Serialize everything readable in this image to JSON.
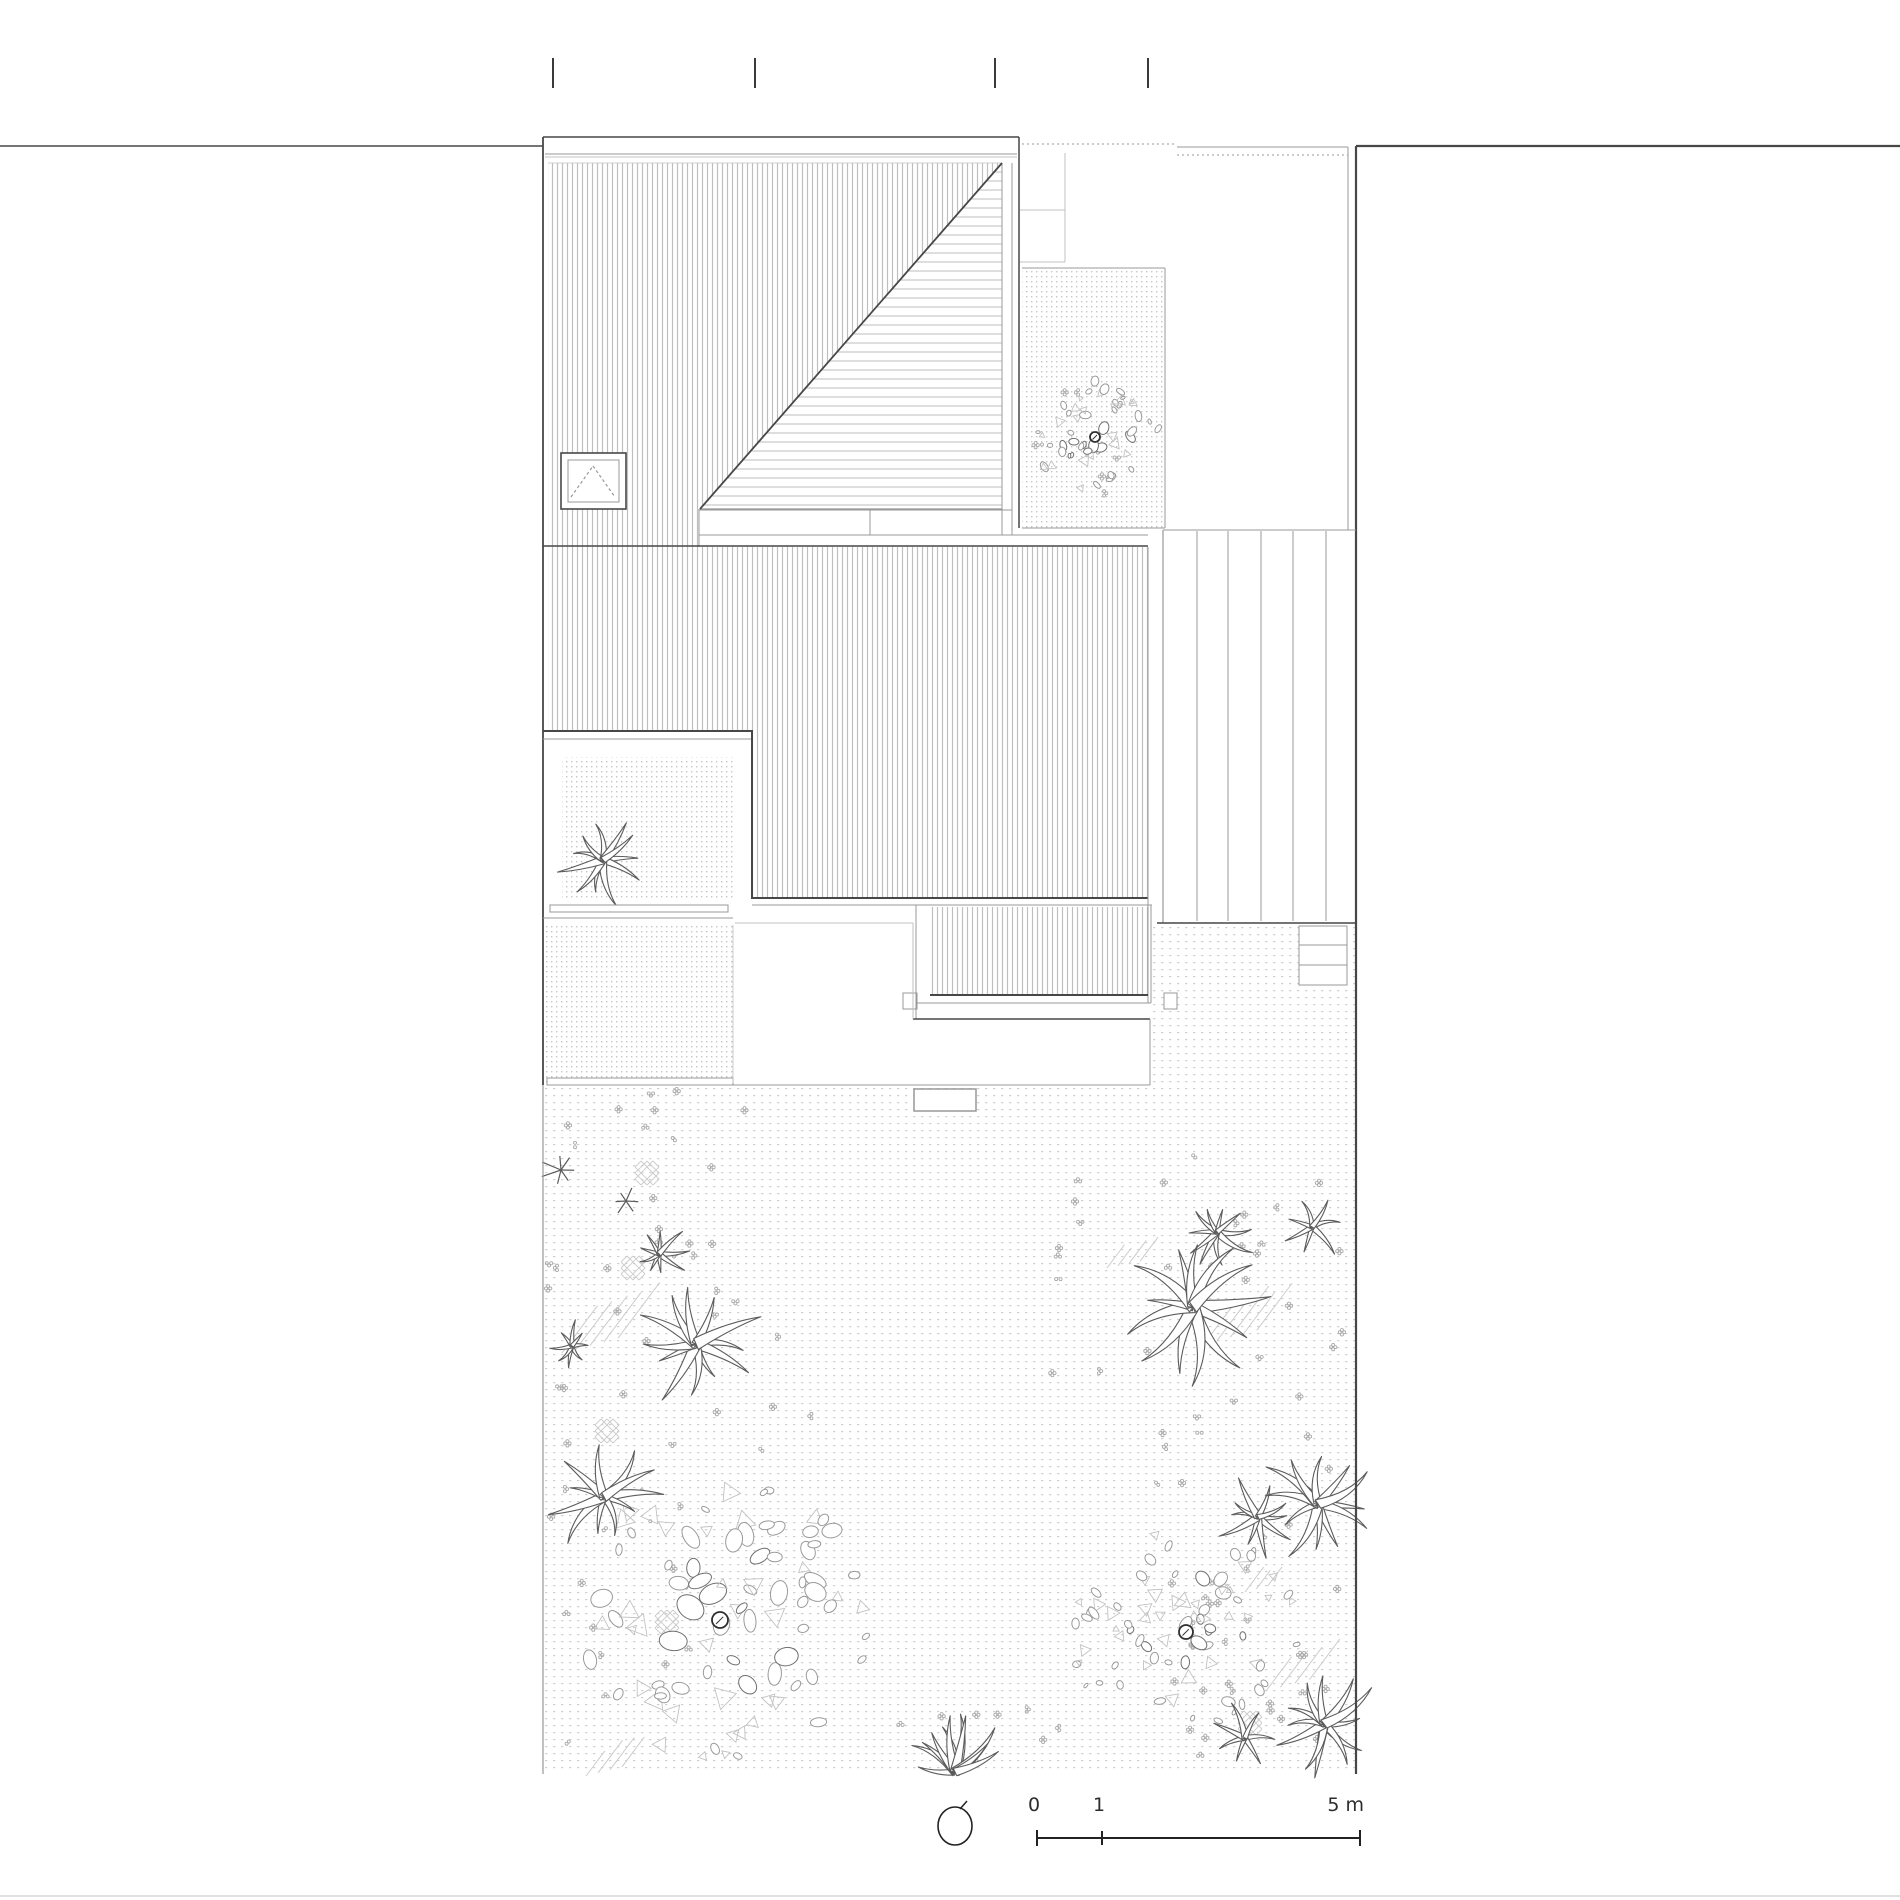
{
  "title": "roof-and-garden-site-plan",
  "legend": {
    "scale": {
      "zero": "0",
      "one": "1",
      "five": "5 m"
    }
  },
  "colors": {
    "dark": "#474747",
    "mid": "#989898",
    "light": "#c0c0c0",
    "hatch": "#bfbfbf",
    "tri_hatch": "#bdbdbd",
    "gravel_dot": "#c6c6c6",
    "garden_dot": "#d0d0d0",
    "stone_dark": "#6f6f6f",
    "stone_mid": "#9a9a9a",
    "stone_light": "#c2c2c2",
    "plant": "#5c5c5c",
    "blossom": "#ababab",
    "patch": "#cccccc"
  },
  "seed": 11,
  "plan": {
    "section_ticks": {
      "xs": [
        553,
        755,
        995,
        1148
      ],
      "y1": 58,
      "y2": 88
    },
    "vhatch_rects": [
      [
        548,
        163,
        454,
        346
      ],
      [
        548,
        509,
        151,
        38
      ],
      [
        548,
        547,
        600,
        184
      ],
      [
        752,
        731,
        396,
        167
      ],
      [
        930,
        907,
        218,
        88
      ]
    ],
    "triangle": {
      "apex_x": 1002,
      "apex_y": 163,
      "base_x": 700,
      "base_y": 509,
      "pitch": 9
    },
    "gravel_rects": [
      [
        545,
        925,
        188,
        158
      ],
      [
        562,
        757,
        173,
        141
      ],
      [
        1022,
        268,
        143,
        260
      ]
    ],
    "garden_rects": [
      [
        545,
        1087,
        605,
        685
      ],
      [
        1150,
        925,
        206,
        847
      ]
    ],
    "white_rects": [
      [
        699,
        510,
        313,
        25,
        "mid",
        1
      ],
      [
        914,
        1089,
        62,
        22,
        "mid",
        1.5
      ],
      [
        1299,
        926,
        48,
        59,
        "mid",
        1
      ],
      [
        550,
        905,
        178,
        7,
        "mid",
        1
      ],
      [
        547,
        1078,
        186,
        7,
        "mid",
        1
      ],
      [
        903,
        993,
        14,
        16,
        "mid",
        1
      ],
      [
        1164,
        993,
        13,
        16,
        "mid",
        1
      ],
      [
        561,
        453,
        65,
        56,
        "dark",
        1.6
      ],
      [
        568,
        460,
        51,
        42,
        "mid",
        1
      ]
    ],
    "lines": [
      [
        0,
        146,
        543,
        146,
        1.4,
        "dark",
        ""
      ],
      [
        1356,
        146,
        1900,
        146,
        2.2,
        "dark",
        ""
      ],
      [
        1356,
        146,
        1356,
        1774,
        2.2,
        "dark",
        ""
      ],
      [
        543,
        137,
        543,
        1085,
        1.8,
        "dark",
        ""
      ],
      [
        543,
        1085,
        543,
        1774,
        1.2,
        "mid",
        ""
      ],
      [
        543,
        137,
        1019,
        137,
        1.6,
        "dark",
        ""
      ],
      [
        545,
        154,
        1017,
        154,
        1,
        "mid",
        ""
      ],
      [
        545,
        157,
        1017,
        157,
        1,
        "light",
        ""
      ],
      [
        1019,
        137,
        1019,
        528,
        1.5,
        "dark",
        ""
      ],
      [
        1002,
        163,
        1002,
        535,
        1,
        "mid",
        ""
      ],
      [
        1012,
        163,
        1012,
        535,
        1,
        "mid",
        ""
      ],
      [
        548,
        163,
        1002,
        163,
        0.8,
        "light",
        ""
      ],
      [
        699,
        509,
        699,
        547,
        1,
        "mid",
        ""
      ],
      [
        700,
        509,
        1002,
        509,
        1.2,
        "mid",
        ""
      ],
      [
        870,
        510,
        870,
        535,
        1,
        "mid",
        ""
      ],
      [
        699,
        535,
        1148,
        535,
        1,
        "mid",
        ""
      ],
      [
        543,
        546,
        1148,
        546,
        1.6,
        "dark",
        ""
      ],
      [
        543,
        731,
        753,
        731,
        2,
        "dark",
        ""
      ],
      [
        543,
        739,
        753,
        739,
        1,
        "mid",
        ""
      ],
      [
        752,
        731,
        752,
        899,
        2,
        "dark",
        ""
      ],
      [
        752,
        898,
        1148,
        898,
        2,
        "dark",
        ""
      ],
      [
        752,
        905,
        1152,
        905,
        1,
        "mid",
        ""
      ],
      [
        1148,
        547,
        1148,
        1003,
        1,
        "mid",
        ""
      ],
      [
        1151,
        905,
        1151,
        1003,
        1,
        "mid",
        ""
      ],
      [
        930,
        995,
        1148,
        995,
        2,
        "dark",
        ""
      ],
      [
        916,
        1003,
        1151,
        1003,
        1,
        "mid",
        ""
      ],
      [
        916,
        905,
        916,
        1019,
        1,
        "mid",
        ""
      ],
      [
        913,
        1019,
        1150,
        1019,
        1.5,
        "dark",
        ""
      ],
      [
        1150,
        1019,
        1150,
        1085,
        1,
        "mid",
        ""
      ],
      [
        735,
        923,
        913,
        923,
        1,
        "light",
        ""
      ],
      [
        913,
        923,
        913,
        1019,
        1,
        "light",
        ""
      ],
      [
        543,
        918,
        733,
        918,
        1,
        "mid",
        ""
      ],
      [
        733,
        1085,
        1150,
        1085,
        1,
        "mid",
        ""
      ],
      [
        733,
        925,
        733,
        1083,
        0.8,
        "light",
        ""
      ],
      [
        1022,
        144,
        1177,
        144,
        1,
        "mid",
        "2,3"
      ],
      [
        1177,
        147,
        1348,
        147,
        1,
        "mid",
        ""
      ],
      [
        1177,
        155,
        1348,
        155,
        1,
        "mid",
        "2,3"
      ],
      [
        1065,
        153,
        1065,
        262,
        1,
        "light",
        ""
      ],
      [
        1020,
        210,
        1065,
        210,
        1,
        "light",
        ""
      ],
      [
        1020,
        262,
        1065,
        262,
        1,
        "light",
        ""
      ],
      [
        1348,
        147,
        1348,
        530,
        1,
        "mid",
        ""
      ],
      [
        1163,
        530,
        1356,
        530,
        1,
        "mid",
        ""
      ],
      [
        1163,
        530,
        1163,
        923,
        1.2,
        "mid",
        ""
      ],
      [
        1197,
        531,
        1197,
        921,
        1,
        "mid",
        ""
      ],
      [
        1228,
        531,
        1228,
        921,
        1,
        "mid",
        ""
      ],
      [
        1261,
        531,
        1261,
        921,
        1,
        "mid",
        ""
      ],
      [
        1293,
        531,
        1293,
        921,
        1,
        "mid",
        ""
      ],
      [
        1326,
        531,
        1326,
        921,
        1,
        "mid",
        ""
      ],
      [
        1157,
        923,
        1356,
        923,
        1.6,
        "dark",
        ""
      ],
      [
        1022,
        268,
        1165,
        268,
        1,
        "mid",
        ""
      ],
      [
        1165,
        268,
        1165,
        528,
        1,
        "mid",
        ""
      ],
      [
        1022,
        528,
        1165,
        528,
        1,
        "mid",
        ""
      ],
      [
        1299,
        945,
        1347,
        945,
        1,
        "mid",
        ""
      ],
      [
        1299,
        965,
        1347,
        965,
        1,
        "mid",
        ""
      ],
      [
        700,
        509,
        1002,
        163,
        1.8,
        "dark",
        ""
      ],
      [
        571,
        497,
        593,
        466,
        1.2,
        "mid",
        "3,2.5"
      ],
      [
        593,
        466,
        615,
        497,
        1.2,
        "mid",
        "3,2.5"
      ],
      [
        0,
        1896,
        1900,
        1896,
        1,
        "light",
        ""
      ]
    ],
    "trees": [
      {
        "c": [
          720,
          1620
        ],
        "r": 150,
        "n": 88,
        "smin": 6,
        "smax": 16,
        "trunk": 8
      },
      {
        "c": [
          1186,
          1632
        ],
        "r": 112,
        "n": 80,
        "smin": 4,
        "smax": 10,
        "trunk": 7
      },
      {
        "c": [
          1095,
          437
        ],
        "r": 62,
        "n": 55,
        "smin": 3,
        "smax": 8,
        "trunk": 5
      }
    ],
    "plants": [
      [
        603,
        860,
        50,
        11
      ],
      [
        561,
        1170,
        19,
        7
      ],
      [
        626,
        1201,
        15,
        6
      ],
      [
        659,
        1254,
        31,
        9
      ],
      [
        572,
        1346,
        26,
        8
      ],
      [
        696,
        1344,
        68,
        12
      ],
      [
        604,
        1497,
        58,
        11
      ],
      [
        955,
        1772,
        62,
        11,
        195,
        345
      ],
      [
        1217,
        1232,
        40,
        10
      ],
      [
        1312,
        1227,
        34,
        7
      ],
      [
        1193,
        1307,
        76,
        13
      ],
      [
        1258,
        1517,
        46,
        10
      ],
      [
        1318,
        1504,
        66,
        12
      ],
      [
        1324,
        1724,
        58,
        12
      ],
      [
        1245,
        1738,
        36,
        7
      ]
    ],
    "blossom_zones": [
      [
        548,
        1090,
        200,
        400,
        30
      ],
      [
        548,
        1490,
        150,
        290,
        16
      ],
      [
        1040,
        1150,
        310,
        330,
        34
      ],
      [
        1150,
        1480,
        200,
        290,
        20
      ],
      [
        860,
        1700,
        200,
        80,
        8
      ],
      [
        690,
        1290,
        130,
        170,
        8
      ],
      [
        1030,
        375,
        120,
        120,
        9
      ],
      [
        1190,
        1560,
        160,
        200,
        12
      ]
    ],
    "patches": [
      [
        635,
        1161
      ],
      [
        621,
        1256
      ],
      [
        595,
        1419
      ],
      [
        655,
        1610
      ],
      [
        1238,
        1711
      ]
    ],
    "dash_groups": [
      [
        562,
        1291,
        70,
        62,
        5
      ],
      [
        1107,
        1238,
        44,
        30,
        4
      ],
      [
        1204,
        1287,
        66,
        57,
        5
      ],
      [
        1245,
        1562,
        34,
        30,
        3
      ],
      [
        1266,
        1640,
        58,
        51,
        4
      ],
      [
        586,
        1735,
        48,
        41,
        4
      ]
    ],
    "north": {
      "cx": 955,
      "cy": 1826,
      "rx": 17,
      "ry": 19
    },
    "scale_bar": {
      "x1": 1037,
      "xm": 1102,
      "x2": 1360,
      "y": 1838,
      "end_tick": 8,
      "mid_tick": 7
    }
  }
}
